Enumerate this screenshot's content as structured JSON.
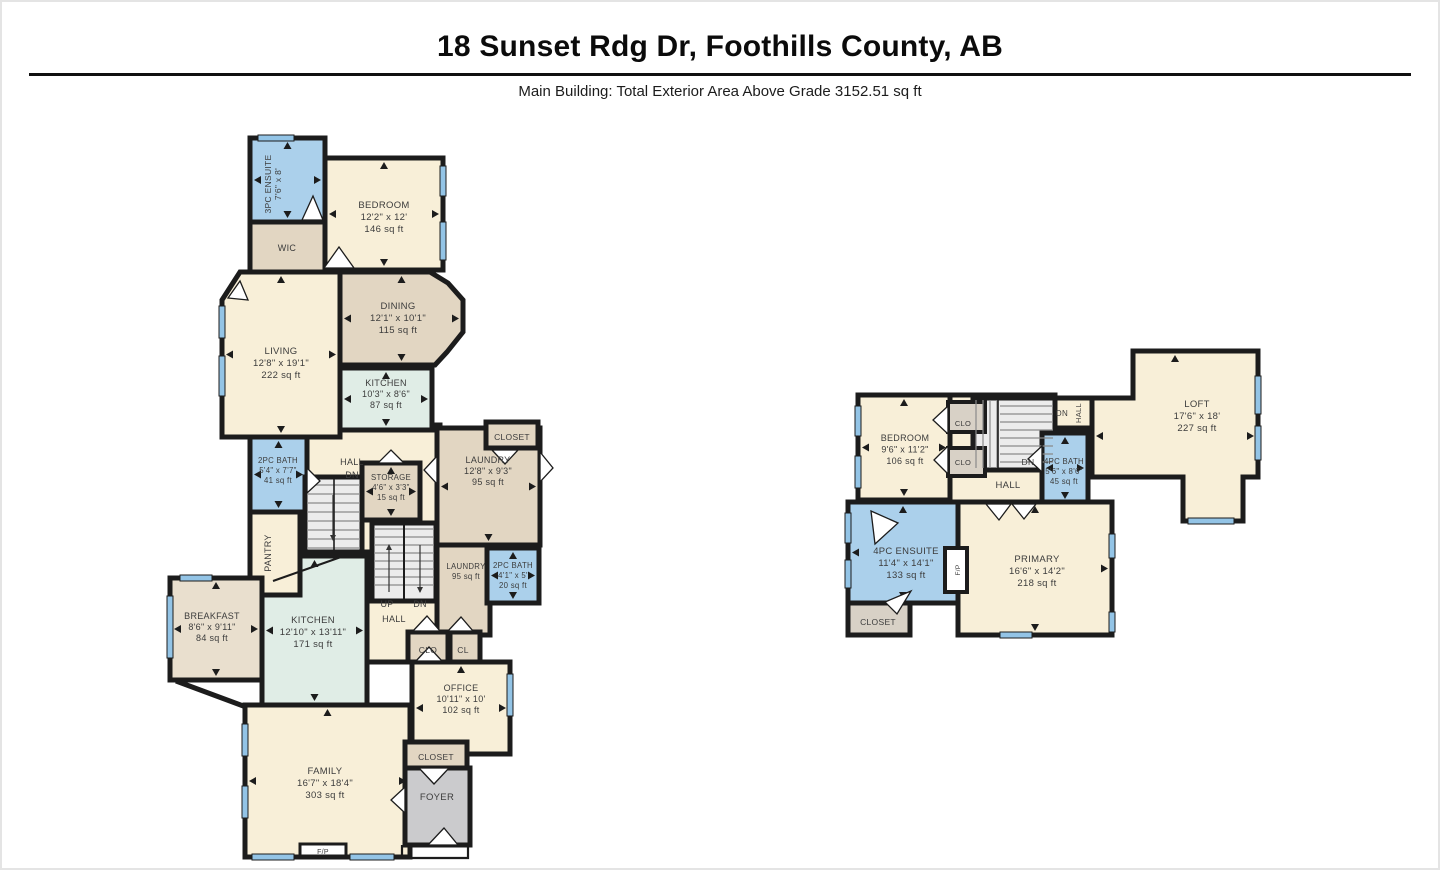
{
  "header": {
    "title": "18 Sunset Rdg Dr, Foothills County, AB",
    "subtitle": "Main Building: Total Exterior Area Above Grade 3152.51 sq ft"
  },
  "colors": {
    "wall": "#1c1c1c",
    "cream": "#F8EFD8",
    "tan": "#E2D6C2",
    "tanLight": "#E9DFCE",
    "mint": "#E0EDE6",
    "bath": "#ABD0EB",
    "grayFloor": "#CBCBCD",
    "closetGray": "#D8D1C6",
    "stairs": "#ECECEC",
    "window": "#93C4E6",
    "label": "#3C3C3C"
  },
  "floors": {
    "main": {
      "rooms": {
        "ensuite3pc": {
          "name": "3PC ENSUITE",
          "dims": "7'6\" x 8'"
        },
        "wic": {
          "name": "WIC"
        },
        "bedroom": {
          "name": "BEDROOM",
          "dims": "12'2\" x 12'",
          "area": "146 sq ft"
        },
        "dining": {
          "name": "DINING",
          "dims": "12'1\" x 10'1\"",
          "area": "115 sq ft"
        },
        "living": {
          "name": "LIVING",
          "dims": "12'8\" x 19'1\"",
          "area": "222 sq ft"
        },
        "kitchen_upper": {
          "name": "KITCHEN",
          "dims": "10'3\" x 8'6\"",
          "area": "87 sq ft"
        },
        "closet_upper": {
          "name": "CLOSET"
        },
        "bath2pc_a": {
          "name": "2PC BATH",
          "dims": "5'4\" x 7'7\"",
          "area": "41 sq ft"
        },
        "storage": {
          "name": "STORAGE",
          "dims": "4'6\" x 3'3\"",
          "area": "15 sq ft"
        },
        "laundry": {
          "name": "LAUNDRY",
          "dims": "12'8\" x 9'3\"",
          "area": "95 sq ft"
        },
        "laundry_small": {
          "name": "LAUNDRY",
          "area": "95 sq ft"
        },
        "pantry": {
          "name": "PANTRY"
        },
        "breakfast": {
          "name": "BREAKFAST",
          "dims": "8'6\" x 9'11\"",
          "area": "84 sq ft"
        },
        "kitchen_main": {
          "name": "KITCHEN",
          "dims": "12'10\" x 13'11\"",
          "area": "171 sq ft"
        },
        "bath2pc_b": {
          "name": "2PC BATH",
          "dims": "4'1\" x 5'",
          "area": "20 sq ft"
        },
        "office": {
          "name": "OFFICE",
          "dims": "10'11\" x 10'",
          "area": "102 sq ft"
        },
        "closet_foyer": {
          "name": "CLOSET"
        },
        "foyer": {
          "name": "FOYER"
        },
        "family": {
          "name": "FAMILY",
          "dims": "16'7\" x 18'4\"",
          "area": "303 sq ft"
        }
      },
      "labels": {
        "hall1": "HALL",
        "dn1": "DN",
        "up": "UP",
        "hall2": "HALL",
        "dn2": "DN",
        "clo": "CLO",
        "cl": "CL",
        "fp": "F/P"
      }
    },
    "upper": {
      "rooms": {
        "bedroom": {
          "name": "BEDROOM",
          "dims": "9'6\" x 11'2\"",
          "area": "106 sq ft"
        },
        "bath4pc": {
          "name": "4PC BATH",
          "dims": "5'6\" x 8'6\"",
          "area": "45 sq ft"
        },
        "loft": {
          "name": "LOFT",
          "dims": "17'6\" x 18'",
          "area": "227 sq ft"
        },
        "ensuite4pc": {
          "name": "4PC ENSUITE",
          "dims": "11'4\" x 14'1\"",
          "area": "133 sq ft"
        },
        "primary": {
          "name": "PRIMARY",
          "dims": "16'6\" x 14'2\"",
          "area": "218 sq ft"
        },
        "closet": {
          "name": "CLOSET"
        }
      },
      "labels": {
        "clo1": "CLO",
        "clo2": "CLO",
        "dn_top": "DN",
        "hall_top": "HALL",
        "dn_stair": "DN",
        "hall": "HALL",
        "fp": "F/P"
      }
    }
  }
}
